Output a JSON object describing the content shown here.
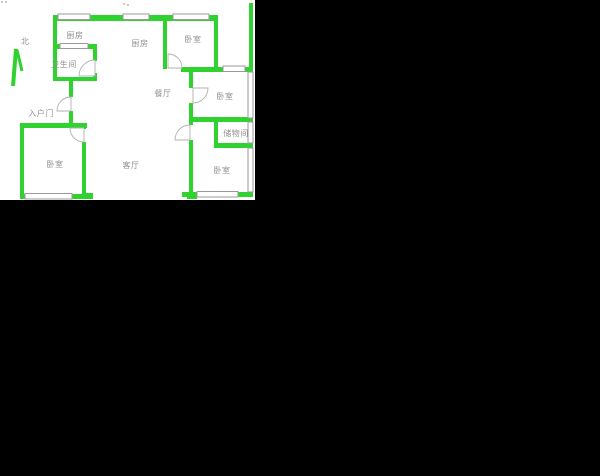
{
  "canvas": {
    "width": 600,
    "height": 476
  },
  "colors": {
    "background": "#000000",
    "plan_bg": "#ffffff",
    "wall": "#2fd22f",
    "window_line": "#9a9a9a",
    "door_line": "#b0b0b0",
    "label_text": "#8f8f8f"
  },
  "floorplan": {
    "compass": {
      "label": "北"
    },
    "rooms": [
      {
        "id": "kitchen-upper",
        "label": "厨房"
      },
      {
        "id": "kitchen",
        "label": "厨房"
      },
      {
        "id": "bedroom-top-right",
        "label": "卧室"
      },
      {
        "id": "bathroom",
        "label": "卫生间"
      },
      {
        "id": "dining-room",
        "label": "餐厅"
      },
      {
        "id": "bedroom-mid-right",
        "label": "卧室"
      },
      {
        "id": "entry-door",
        "label": "入户门"
      },
      {
        "id": "storage-room",
        "label": "储物间"
      },
      {
        "id": "bedroom-left",
        "label": "卧室"
      },
      {
        "id": "living-room",
        "label": "客厅"
      },
      {
        "id": "bedroom-bottom-right",
        "label": "卧室"
      }
    ]
  }
}
